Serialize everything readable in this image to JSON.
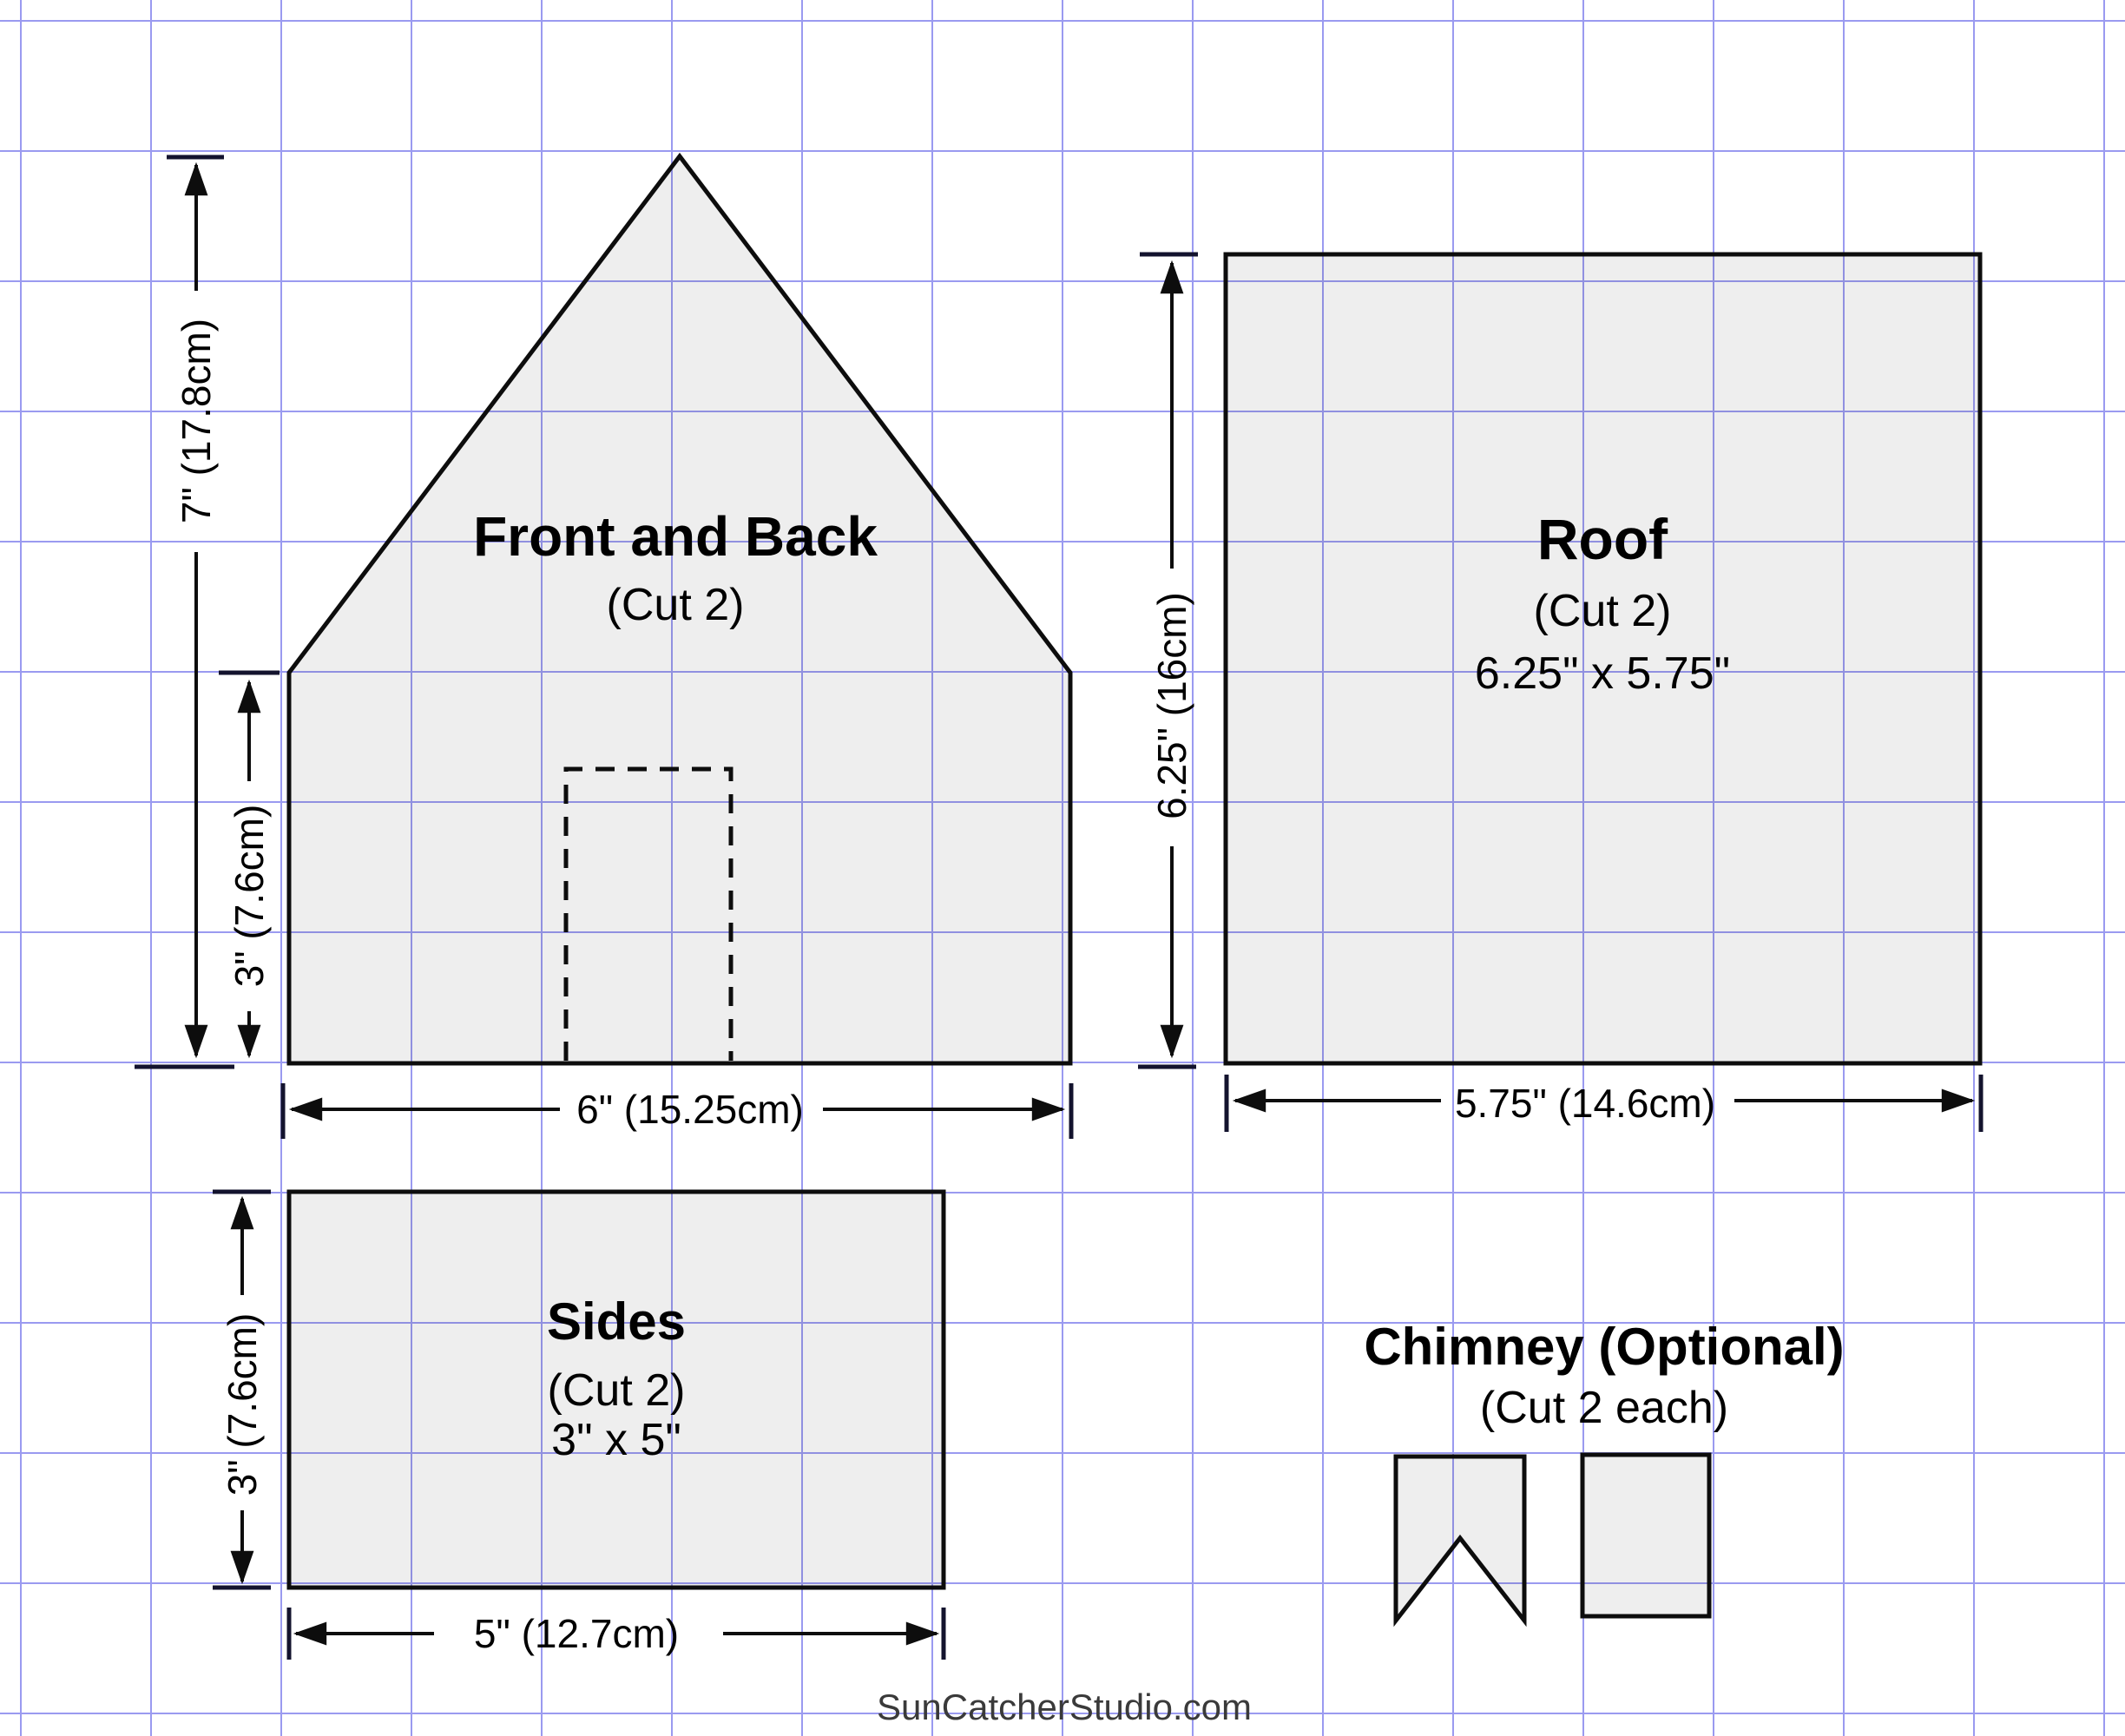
{
  "page": {
    "watermark": "SunCatcherStudio.com"
  },
  "colors": {
    "background": "#ffffff",
    "grid_line": "#9a9af0",
    "outline": "#0d0d0d",
    "piece_fill": "rgba(20,20,20,0.072)",
    "dimension_ink": "#0d0d0d",
    "watermark": "#3a3a3a"
  },
  "pieces": {
    "front_back": {
      "title": "Front and Back",
      "cut": "(Cut 2)"
    },
    "roof": {
      "title": "Roof",
      "cut": "(Cut 2)",
      "size": "6.25\" x 5.75\""
    },
    "sides": {
      "title": "Sides",
      "cut": "(Cut 2)",
      "size": "3\" x 5\""
    },
    "chimney": {
      "title": "Chimney (Optional)",
      "cut": "(Cut 2 each)"
    }
  },
  "dimensions": {
    "front_total_height": "7\" (17.8cm)",
    "front_wall_height": "3\" (7.6cm)",
    "front_width": "6\" (15.25cm)",
    "roof_height": "6.25\" (16cm)",
    "roof_width": "5.75\" (14.6cm)",
    "sides_height": "3\" (7.6cm)",
    "sides_width": "5\" (12.7cm)"
  }
}
